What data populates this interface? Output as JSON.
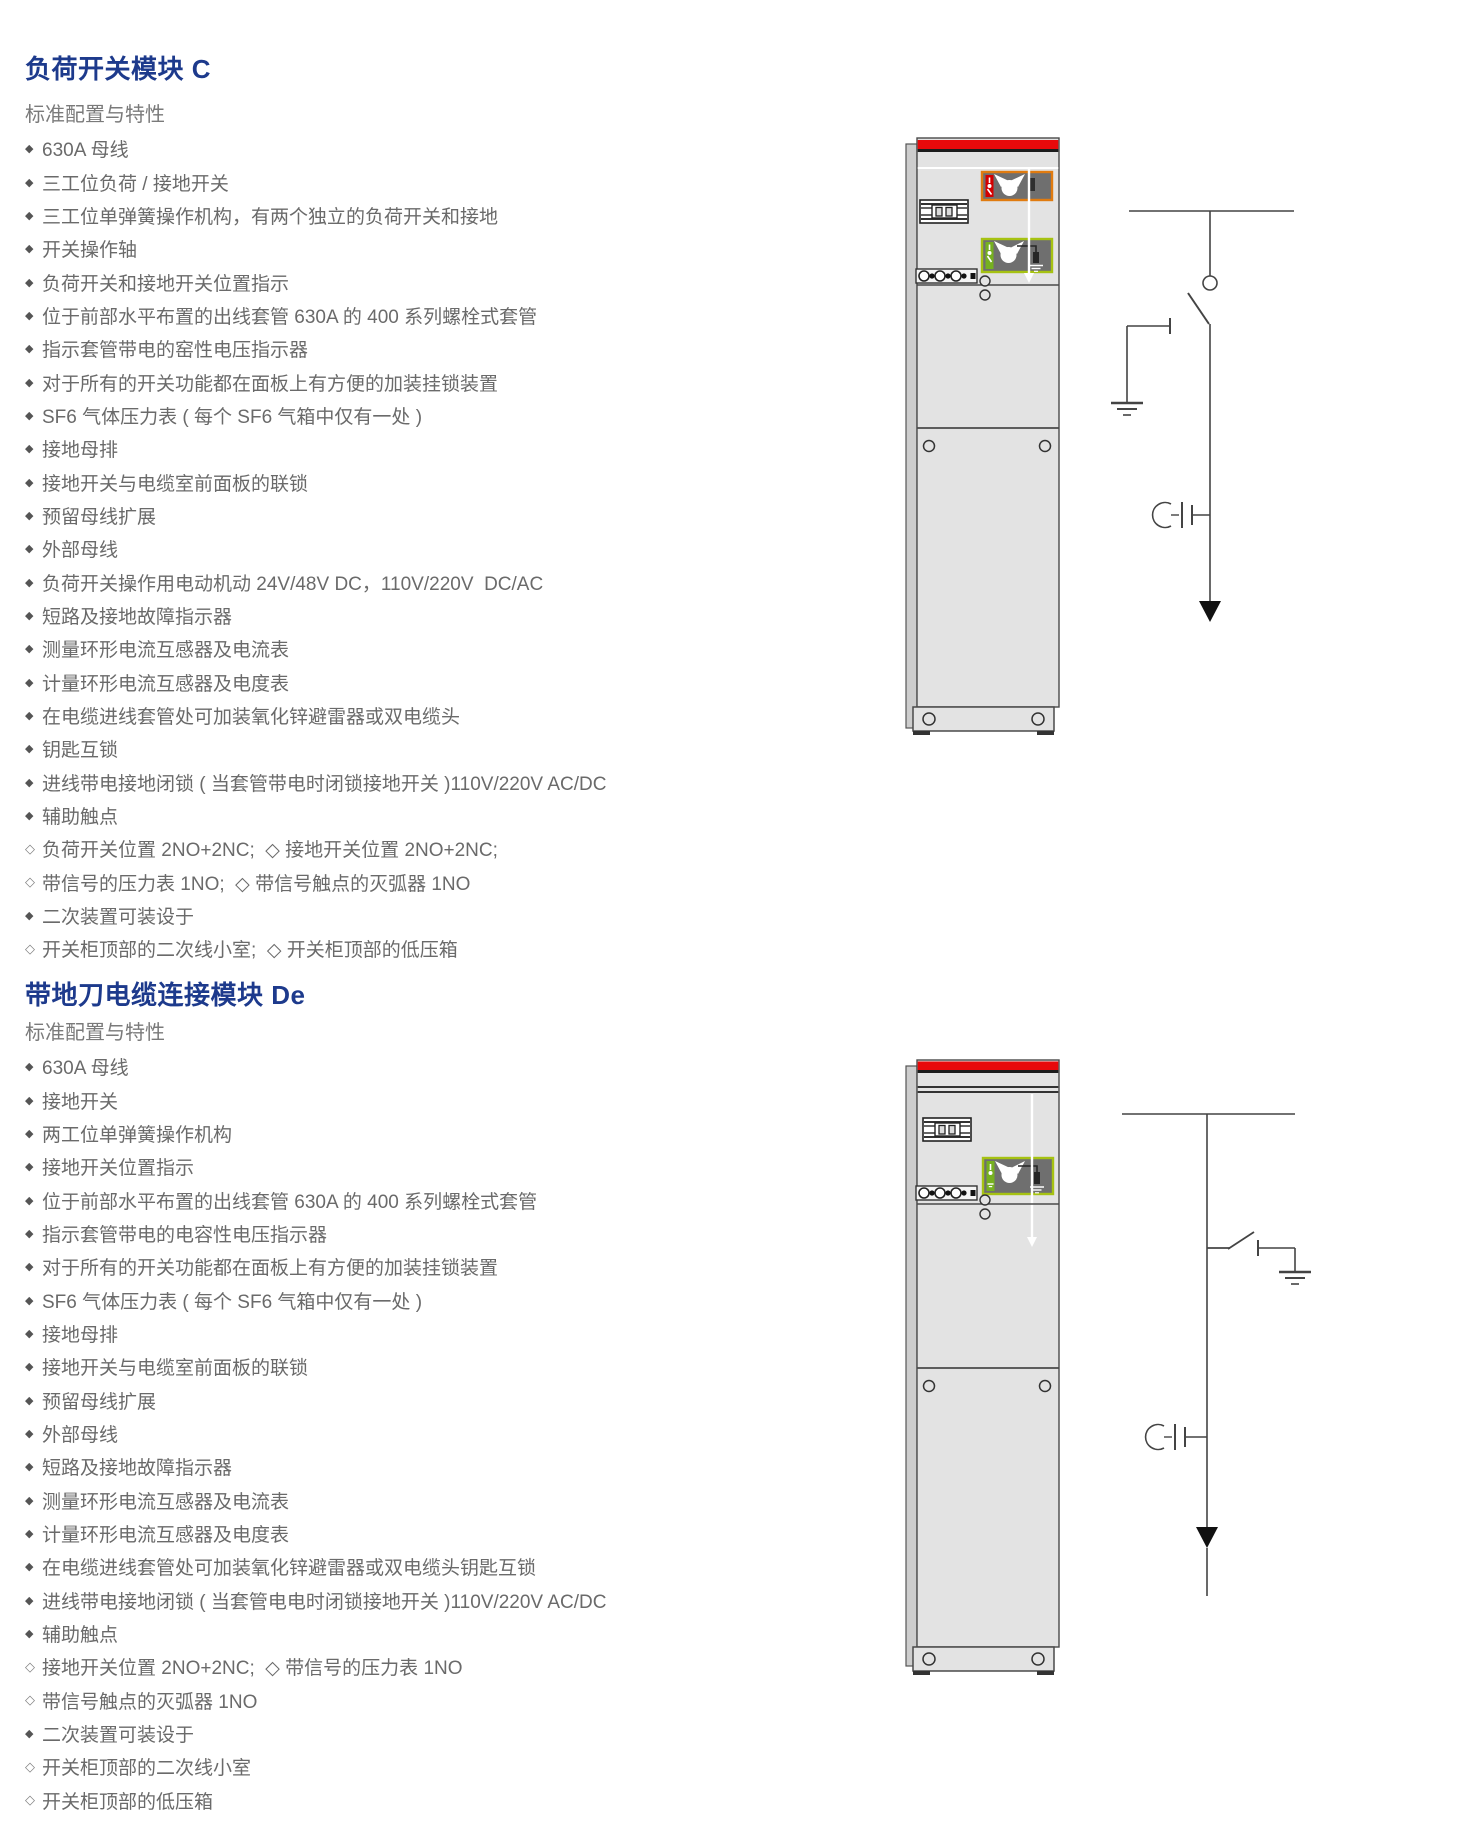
{
  "colors": {
    "title_blue": "#1d3a8c",
    "body_text_gray": "#6a6a6a",
    "cabinet_top_band_red": "#e8090b",
    "switch_indicator_frame_orange": "#e07b10",
    "earth_indicator_frame_green": "#a6c212",
    "cabinet_body_gray": "#e3e3e3"
  },
  "sections": [
    {
      "id": "module-c",
      "title": "负荷开关模块 C",
      "subtitle": "标准配置与特性",
      "items": [
        {
          "marker": "filled",
          "text": "630A 母线"
        },
        {
          "marker": "filled",
          "text": "三工位负荷 / 接地开关"
        },
        {
          "marker": "filled",
          "text": "三工位单弹簧操作机构，有两个独立的负荷开关和接地"
        },
        {
          "marker": "filled",
          "text": "开关操作轴"
        },
        {
          "marker": "filled",
          "text": "负荷开关和接地开关位置指示"
        },
        {
          "marker": "filled",
          "text": "位于前部水平布置的出线套管 630A 的 400 系列螺栓式套管"
        },
        {
          "marker": "filled",
          "text": "指示套管带电的窑性电压指示器"
        },
        {
          "marker": "filled",
          "text": "对于所有的开关功能都在面板上有方便的加装挂锁装置"
        },
        {
          "marker": "filled",
          "text": "SF6 气体压力表 ( 每个 SF6 气箱中仅有一处 )"
        },
        {
          "marker": "filled",
          "text": "接地母排"
        },
        {
          "marker": "filled",
          "text": "接地开关与电缆室前面板的联锁"
        },
        {
          "marker": "filled",
          "text": "预留母线扩展"
        },
        {
          "marker": "filled",
          "text": "外部母线"
        },
        {
          "marker": "filled",
          "text": "负荷开关操作用电动机动 24V/48V DC，110V/220V  DC/AC"
        },
        {
          "marker": "filled",
          "text": "短路及接地故障指示器"
        },
        {
          "marker": "filled",
          "text": "测量环形电流互感器及电流表"
        },
        {
          "marker": "filled",
          "text": "计量环形电流互感器及电度表"
        },
        {
          "marker": "filled",
          "text": "在电缆进线套管处可加装氧化锌避雷器或双电缆头"
        },
        {
          "marker": "filled",
          "text": "钥匙互锁"
        },
        {
          "marker": "filled",
          "text": "进线带电接地闭锁 ( 当套管带电时闭锁接地开关 )110V/220V AC/DC"
        },
        {
          "marker": "filled",
          "text": "辅助触点"
        },
        {
          "marker": "open",
          "text": "负荷开关位置 2NO+2NC;  ◇ 接地开关位置 2NO+2NC;"
        },
        {
          "marker": "open",
          "text": "带信号的压力表 1NO;  ◇ 带信号触点的灭弧器 1NO"
        },
        {
          "marker": "filled",
          "text": "二次装置可装设于"
        },
        {
          "marker": "open",
          "text": "开关柜顶部的二次线小室;  ◇ 开关柜顶部的低压箱"
        }
      ]
    },
    {
      "id": "module-de",
      "title": "带地刀电缆连接模块 De",
      "subtitle": "标准配置与特性",
      "items": [
        {
          "marker": "filled",
          "text": "630A 母线"
        },
        {
          "marker": "filled",
          "text": "接地开关"
        },
        {
          "marker": "filled",
          "text": "两工位单弹簧操作机构"
        },
        {
          "marker": "filled",
          "text": "接地开关位置指示"
        },
        {
          "marker": "filled",
          "text": "位于前部水平布置的出线套管 630A 的 400 系列螺栓式套管"
        },
        {
          "marker": "filled",
          "text": "指示套管带电的电容性电压指示器"
        },
        {
          "marker": "filled",
          "text": "对于所有的开关功能都在面板上有方便的加装挂锁装置"
        },
        {
          "marker": "filled",
          "text": "SF6 气体压力表 ( 每个 SF6 气箱中仅有一处 )"
        },
        {
          "marker": "filled",
          "text": "接地母排"
        },
        {
          "marker": "filled",
          "text": "接地开关与电缆室前面板的联锁"
        },
        {
          "marker": "filled",
          "text": "预留母线扩展"
        },
        {
          "marker": "filled",
          "text": "外部母线"
        },
        {
          "marker": "filled",
          "text": "短路及接地故障指示器"
        },
        {
          "marker": "filled",
          "text": "测量环形电流互感器及电流表"
        },
        {
          "marker": "filled",
          "text": "计量环形电流互感器及电度表"
        },
        {
          "marker": "filled",
          "text": "在电缆进线套管处可加装氧化锌避雷器或双电缆头钥匙互锁"
        },
        {
          "marker": "filled",
          "text": "进线带电接地闭锁 ( 当套管电电时闭锁接地开关 )110V/220V AC/DC"
        },
        {
          "marker": "filled",
          "text": "辅助触点"
        },
        {
          "marker": "open",
          "text": "接地开关位置 2NO+2NC;  ◇ 带信号的压力表 1NO"
        },
        {
          "marker": "open",
          "text": "带信号触点的灭弧器 1NO"
        },
        {
          "marker": "filled",
          "text": "二次装置可装设于"
        },
        {
          "marker": "open",
          "text": "开关柜顶部的二次线小室"
        },
        {
          "marker": "open",
          "text": "开关柜顶部的低压箱"
        }
      ]
    }
  ],
  "illustrations": {
    "cabinet_c": "switchgear-cabinet-front-view-module-c",
    "diagram_c": "single-line-diagram-load-break-switch",
    "cabinet_de": "switchgear-cabinet-front-view-module-de",
    "diagram_de": "single-line-diagram-earthing-switch"
  }
}
